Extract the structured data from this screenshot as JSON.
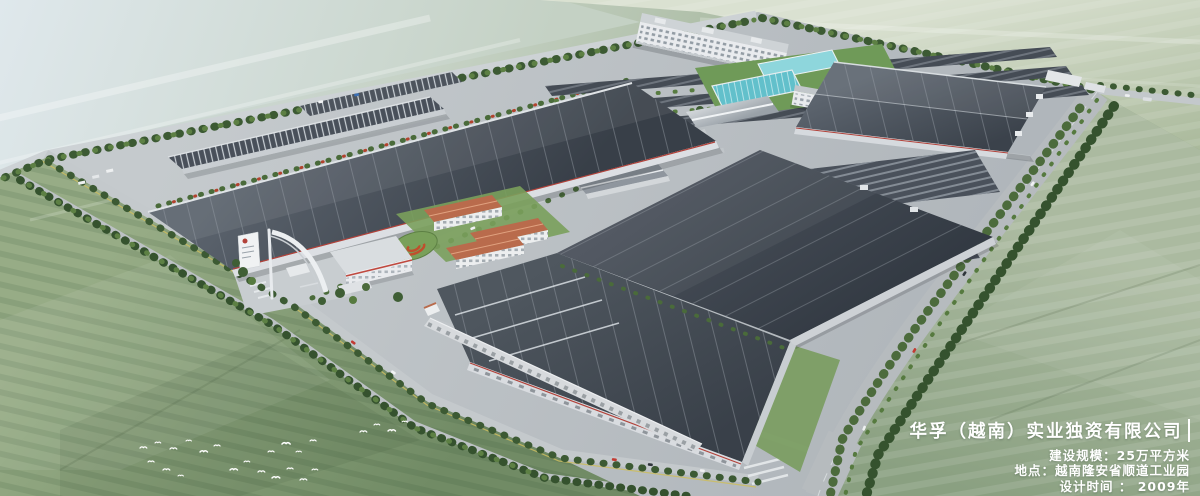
{
  "overlay": {
    "company_name": "华孚（越南）实业独资有限公司",
    "details": [
      "建设规模：25万平方米",
      "地点：越南隆安省顺道工业园",
      "设计时间 ： 2009年"
    ]
  },
  "palette": {
    "field_pale_blue": "#cfdbe0",
    "field_green": "#8da17e",
    "campus_concrete": "#bbc0c4",
    "roof_dark": "#3e454e",
    "roof_light": "#5a626b",
    "wall_white": "#e9ebee",
    "accent_red": "#b2423a",
    "roof_terracotta": "#b96b4c",
    "water_teal": "#62c0cb",
    "tree_green": "#3c5a33",
    "text_white": "#ffffff"
  }
}
